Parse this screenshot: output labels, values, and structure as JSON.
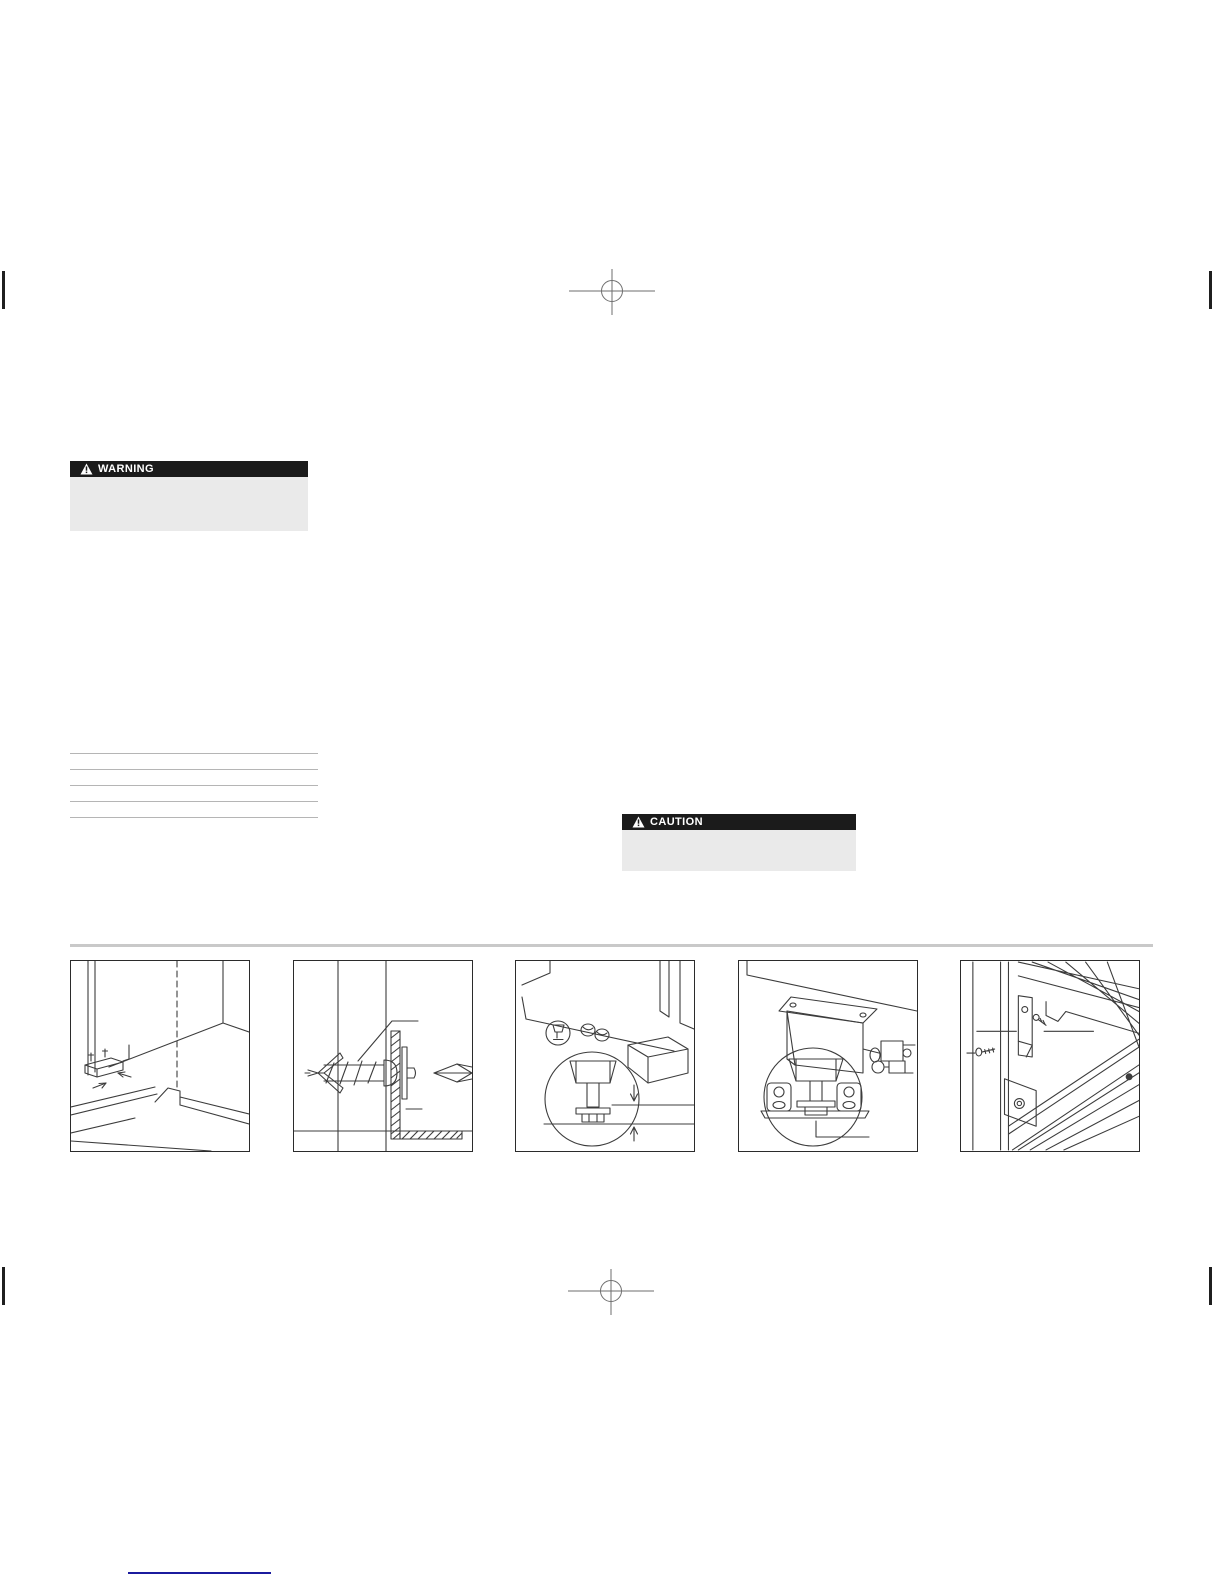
{
  "alerts": {
    "warning": {
      "label": "WARNING"
    },
    "caution": {
      "label": "CAUTION"
    }
  },
  "blank_list": {
    "line_count": 5
  },
  "figures": [
    {
      "name": "anti-tip-bracket-floor-corner"
    },
    {
      "name": "wall-anchor-screw-into-bracket"
    },
    {
      "name": "leveling-leg-height-gap-detail"
    },
    {
      "name": "leveling-leg-retainer-bracket-detail"
    },
    {
      "name": "shelf-bracket-mounting-screws"
    }
  ],
  "colors": {
    "page_bg": "#ffffff",
    "alert_header_bg": "#1b1b1b",
    "alert_header_text": "#ffffff",
    "alert_body_bg": "#eaeaea",
    "blank_line": "#b5b5b5",
    "divider": "#c9c9c9",
    "line_art": "#3c3c3c",
    "panel_border": "#2b2b2b",
    "crop_mark": "#6e6e6e",
    "edge_tick": "#1f1f1f",
    "footer_link": "#1b1b9e"
  }
}
